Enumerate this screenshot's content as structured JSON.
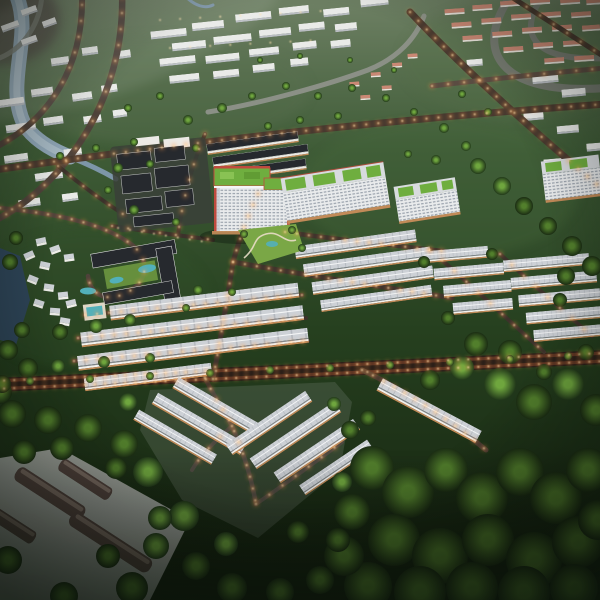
{
  "scene": {
    "alt": "Aerial dusk rendering of a master-planned township: lit boulevards, white rowhouse blocks, a green-roofed apartment tower, villa cluster with pools, warehouses, rivers and dense dark-green forest."
  },
  "colors": {
    "bg_top": "#6e8064",
    "bg_mid": "#3f5c37",
    "bg_low": "#26401f",
    "bg_bottom": "#131f0e",
    "forest_dark": "#1b2d13",
    "tree_mid": "#2e4d1d",
    "tree_hi": "#527f2c",
    "tree_bright": "#6fa63e",
    "canopy_deep": "#22391a",
    "water_river": "#8fa6b6",
    "water_hi": "#b6c6d0",
    "water_canal": "#7d96a8",
    "water_pond": "#2e4558",
    "pool": "#52b0ba",
    "road_grey": "#757a70",
    "road_concrete": "#8b9086",
    "road_dark": "#46382f",
    "street_dark": "#3c322b",
    "avenue_asphalt": "#241b17",
    "avenue_tint": "#7c402a",
    "light_warm": "#ffe2b0",
    "light_glow": "#ff9c4a",
    "bldg_white": "#e9eae8",
    "bldg_side": "#b9bdc2",
    "roof_light": "#cdd1d6",
    "ridge_line": "#9aa0a8",
    "roof_dark": "#26292e",
    "roof_salmon": "#c98874",
    "roof_green": "#6fae3f",
    "accent_red": "#bf4a3e",
    "warm_strip": "#c18a58",
    "win_base": "#e9ebec",
    "win_glass": "#9ba3ad",
    "pad_grey": "#a8aca6",
    "ware_body": "#50423c",
    "ware_top": "#837369",
    "park_green": "#7aa746",
    "path_light": "#e9ddc6",
    "shade": "#0a120a"
  }
}
